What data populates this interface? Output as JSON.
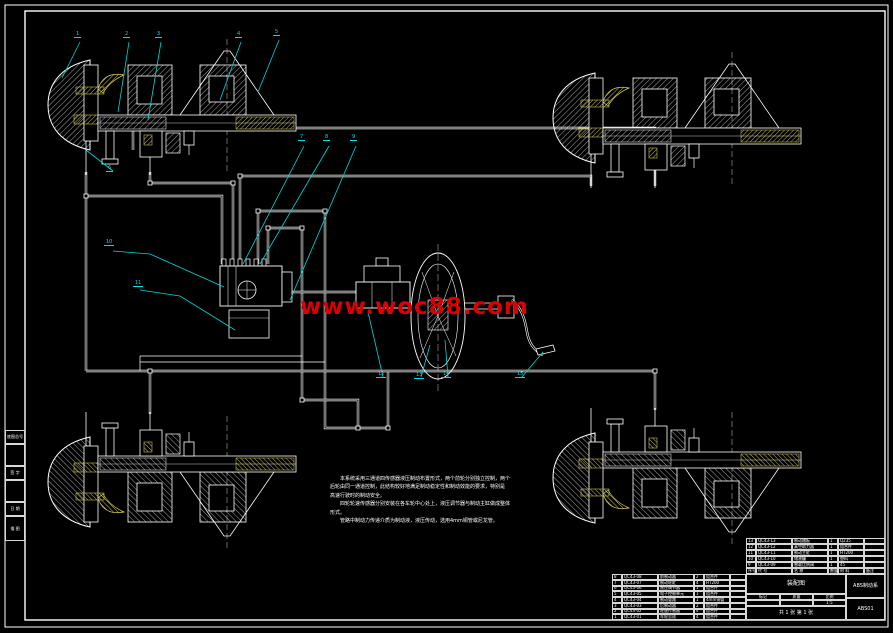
{
  "watermark": {
    "text": "www.woc88.com",
    "color": "#dc0000"
  },
  "colors": {
    "line": "#ffffff",
    "hatch_yellow": "#e6df6e",
    "callout": "#00e0e0",
    "background": "#000000"
  },
  "callouts": {
    "labels": [
      "1",
      "2",
      "3",
      "4",
      "5",
      "6",
      "7",
      "8",
      "9",
      "10",
      "11",
      "12",
      "13",
      "14",
      "15"
    ]
  },
  "notes": {
    "lines": [
      "　　本系统采用三通道四传感器液压制动布置形式，两个前轮分别独立控制，两个",
      "后轮由同一通道控制，此结构较好地满足制动稳定性和制动效能的要求，特别是",
      "高速行驶时的制动安全。",
      "　　四轮轮速传感器分别安装在各车轮中心处上，液压调节器与制动主缸做成整体",
      "形式。",
      "　　管路中制动力传递介质为制动液，液压传动，选用4mm铜管或尼龙管。"
    ]
  },
  "frame_labels": {
    "boxes": [
      "底图总号",
      "",
      "签 字",
      "",
      "日 期",
      "描 图"
    ]
  },
  "title_block": {
    "bom_right": [
      {
        "seq": "13",
        "code": "QC43-13",
        "name": "制动踏板",
        "qty": "1",
        "mat": "Q235",
        "note": ""
      },
      {
        "seq": "12",
        "code": "QC43-12",
        "name": "真空助力器",
        "qty": "1",
        "mat": "组合件",
        "note": ""
      },
      {
        "seq": "11",
        "code": "QC43-11",
        "name": "制动主缸",
        "qty": "1",
        "mat": "HT200",
        "note": ""
      },
      {
        "seq": "10",
        "code": "QC43-10",
        "name": "储液罐",
        "qty": "1",
        "mat": "塑料",
        "note": ""
      },
      {
        "seq": "9",
        "code": "QC43-09",
        "name": "感载比例阀",
        "qty": "1",
        "mat": "45",
        "note": ""
      }
    ],
    "bom_header": {
      "seq": "序号",
      "code": "代 号",
      "name": "名 称",
      "qty": "数量",
      "mat": "材 料",
      "note": "备注"
    },
    "bom_left": [
      {
        "seq": "8",
        "code": "QC43-08",
        "name": "前制动器",
        "qty": "2",
        "mat": "组合件",
        "note": ""
      },
      {
        "seq": "7",
        "code": "QC43-07",
        "name": "制动轮缸",
        "qty": "4",
        "mat": "HT200",
        "note": ""
      },
      {
        "seq": "6",
        "code": "QC43-06",
        "name": "液压调节器",
        "qty": "1",
        "mat": "组合件",
        "note": ""
      },
      {
        "seq": "5",
        "code": "QC43-05",
        "name": "电子控制单元",
        "qty": "1",
        "mat": "组合件",
        "note": ""
      },
      {
        "seq": "4",
        "code": "QC43-04",
        "name": "制动管路",
        "qty": "1",
        "mat": "4mm铜管",
        "note": ""
      },
      {
        "seq": "3",
        "code": "QC43-03",
        "name": "后制动器",
        "qty": "2",
        "mat": "组合件",
        "note": ""
      },
      {
        "seq": "2",
        "code": "QC43-02",
        "name": "轮速传感器",
        "qty": "4",
        "mat": "组合件",
        "note": ""
      },
      {
        "seq": "1",
        "code": "QC43-01",
        "name": "车轮总成",
        "qty": "4",
        "mat": "组合件",
        "note": ""
      }
    ],
    "stage_cell": "装配图",
    "mark_label": "标记",
    "mass_label": "质量",
    "scale_label": "比例",
    "scale_value": "1:5",
    "sheet_info": "共 1 张 第 1 张",
    "title_top": "ABS制动系",
    "title_bottom": "ABS01"
  }
}
